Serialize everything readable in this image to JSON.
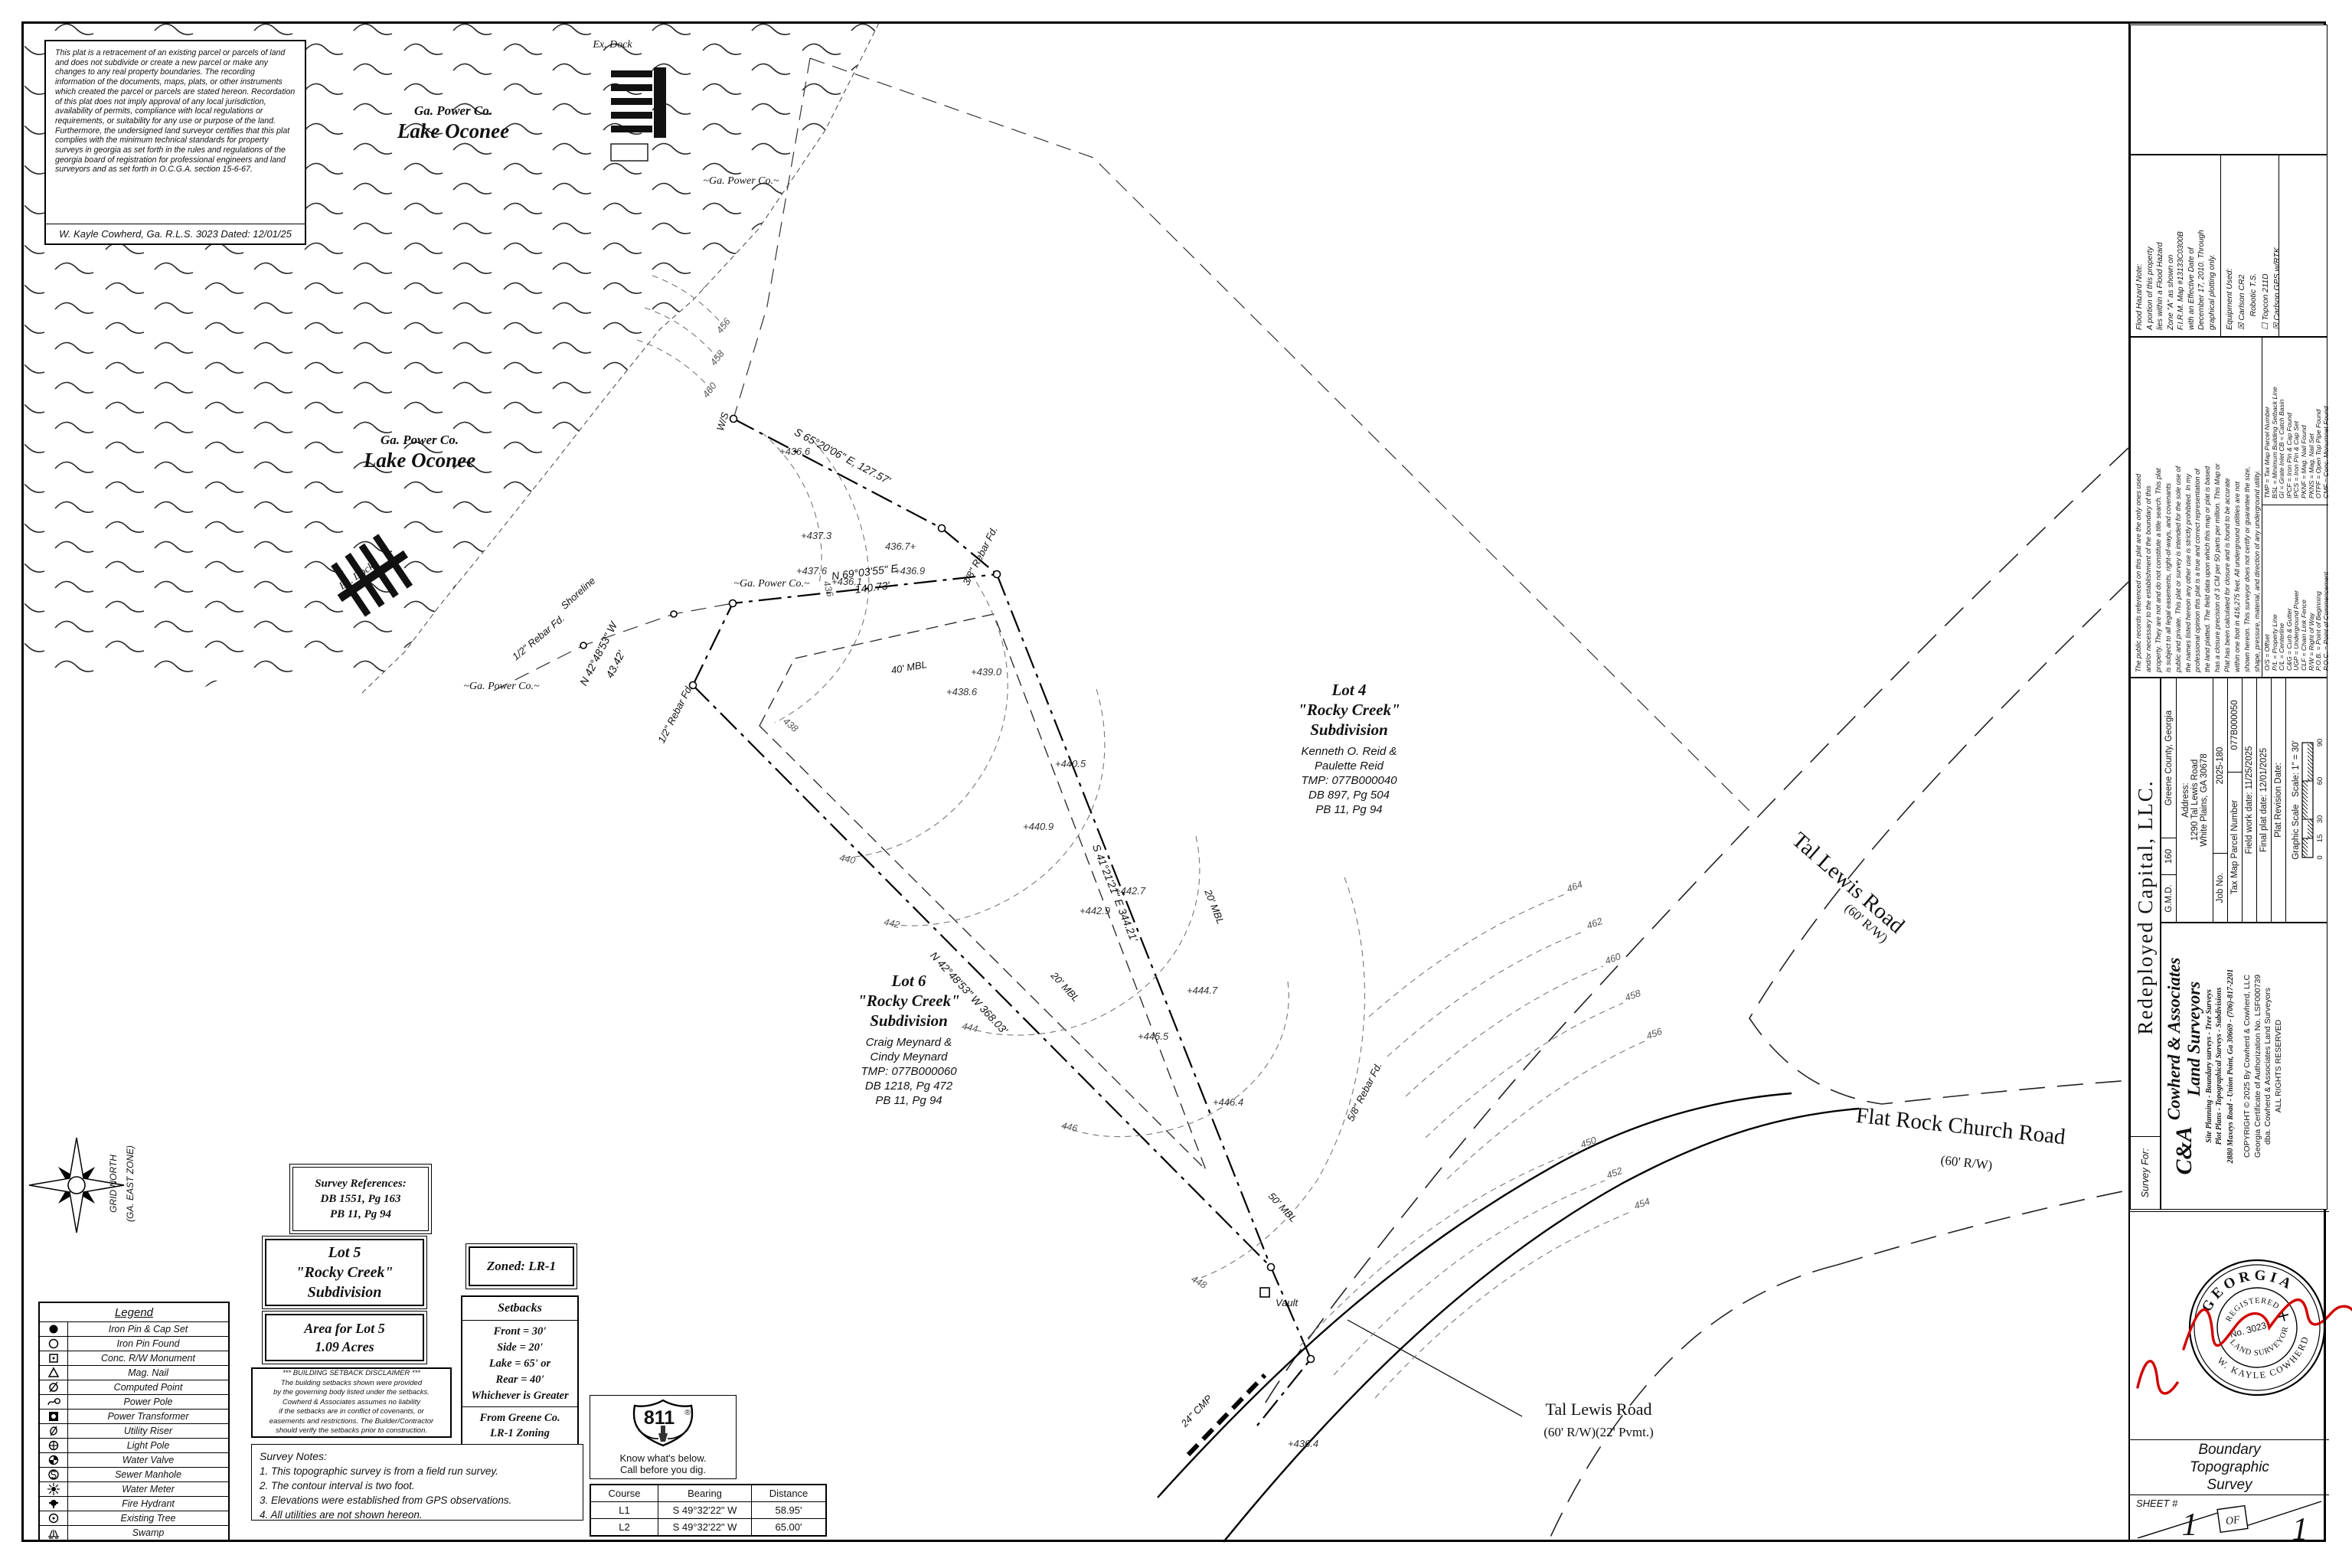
{
  "disclaimer": {
    "text": "This plat is a retracement of an existing parcel or parcels of land and does not subdivide or create a new parcel or make any changes to any real property boundaries. The recording information of the documents, maps, plats, or other instruments which created the parcel or parcels are stated hereon. Recordation of this plat does not imply approval of any local jurisdiction, availability of permits, compliance with local regulations or requirements, or suitability for any use or purpose of the land. Furthermore, the undersigned land surveyor certifies that this plat complies with the minimum technical standards for property surveys in georgia as set forth in the rules and regulations of the georgia board of registration for professional engineers and land surveyors and as set forth in O.C.G.A. section 15-6-67.",
    "signature_line": "W. Kayle Cowherd, Ga. R.L.S. 3023 Dated: 12/01/25"
  },
  "lake": {
    "owner": "Ga. Power Co.",
    "name": "Lake Oconee"
  },
  "map": {
    "labels": {
      "ex_dock_top": "Ex. Dock",
      "ex_dock_left": "Ex. Dock",
      "ga_power_1": "~Ga. Power Co.~",
      "ga_power_2": "~Ga. Power Co.~",
      "ga_power_3": "~Ga. Power Co.~",
      "ws": "W/S",
      "shoreline": "Shoreline",
      "bearing_shore": "S 65°20'06\" E, 127.57'",
      "bearing_top": "N 69°03'55\" E",
      "dist_top": "140.73'",
      "bearing_left": "N 42°48'53\" W",
      "dist_left": "43.42'",
      "bearing_right": "S 41°21'21\" E  344.21'",
      "bearing_bottom": "N 42°48'53\" W  368.03'",
      "rebar_half_1": "1/2\" Rebar Fd.",
      "rebar_half_2": "1/2\" Rebar Fd.",
      "rebar_38": "3/8\" Rebar Fd.",
      "rebar_58": "5/8\" Rebar Fd.",
      "mbl40": "40' MBL",
      "mbl20_right": "20' MBL",
      "mbl20_bottom": "20' MBL",
      "mbl50": "50' MBL",
      "vault": "Vault",
      "cmp": "24\" CMP",
      "tal_lewis_1": "Tal Lewis Road",
      "tal_lewis_1_rw": "(60' R/W)",
      "flat_rock": "Flat Rock Church Road",
      "flat_rock_rw": "(60' R/W)",
      "tal_lewis_2": "Tal Lewis Road",
      "tal_lewis_2_rw": "(60' R/W)(22' Pvmt.)",
      "grid_north": "GRID NORTH",
      "grid_zone": "(GA. EAST ZONE)"
    },
    "lot4": {
      "title": "Lot 4\n\"Rocky Creek\"\nSubdivision",
      "owner": "Kenneth O. Reid &\nPaulette Reid\nTMP: 077B000040\nDB 897, Pg 504\nPB 11, Pg 94"
    },
    "lot6": {
      "title": "Lot 6\n\"Rocky Creek\"\nSubdivision",
      "owner": "Craig Meynard &\nCindy Meynard\nTMP: 077B000060\nDB 1218, Pg 472\nPB 11, Pg 94"
    },
    "spots": [
      "+436.6",
      "+437.3",
      "+437.6",
      "+436.1",
      "436.7+",
      "+436.9",
      "+438.6",
      "+439.0",
      "+440.5",
      "+440.9",
      "+442.7",
      "+442.9",
      "+444.7",
      "+445.5",
      "+446.4",
      "+436.4"
    ],
    "contours": [
      "436",
      "438",
      "440",
      "442",
      "444",
      "446",
      "448",
      "450",
      "452",
      "454",
      "456",
      "458",
      "460",
      "462",
      "464",
      "456",
      "458",
      "460"
    ]
  },
  "boxes": {
    "survey_references": "Survey References:\nDB 1551, Pg 163\nPB 11, Pg 94",
    "lot5": "Lot 5\n\"Rocky Creek\"\nSubdivision",
    "area": "Area for Lot 5\n1.09 Acres",
    "zoned": "Zoned: LR-1",
    "setbacks_title": "Setbacks",
    "setbacks_values": "Front = 30'\nSide = 20'\nLake = 65' or\nRear = 40'\nWhichever is Greater",
    "setbacks_source": "From Greene Co.\nLR-1 Zoning",
    "setback_disclaimer": "*** BUILDING SETBACK DISCLAIMER ***\nThe building setbacks shown were provided\nby the governing body listed under the setbacks.\nCowherd & Associates assumes no liability\nif the setbacks are in conflict of covenants, or\neasements and restrictions. The Builder/Contractor\nshould verify the setbacks prior to construction.",
    "notes_title": "Survey Notes:",
    "notes": "1.  This topographic survey is from a field run survey.\n2.  The contour interval is two foot.\n3.  Elevations were established from GPS observations.\n4.  All utilities are not shown hereon."
  },
  "legend": {
    "title": "Legend",
    "items": [
      "Iron Pin & Cap Set",
      "Iron Pin Found",
      "Conc. R/W Monument",
      "Mag. Nail",
      "Computed Point",
      "Power Pole",
      "Power Transformer",
      "Utility Riser",
      "Light Pole",
      "Water Valve",
      "Sewer Manhole",
      "Water Meter",
      "Fire Hydrant",
      "Existing Tree",
      "Swamp"
    ]
  },
  "call811": {
    "number": "811",
    "reg": "®",
    "line1": "Know what's below.",
    "line2": "Call before you dig."
  },
  "course_table": {
    "headers": [
      "Course",
      "Bearing",
      "Distance"
    ],
    "rows": [
      [
        "L1",
        "S 49°32'22\" W",
        "58.95'"
      ],
      [
        "L2",
        "S 49°32'22\" W",
        "65.00'"
      ]
    ]
  },
  "title_block": {
    "survey_for_label": "Survey For:",
    "client": "Redeployed Capital, LLC.",
    "company": {
      "monogram": "C&A",
      "name1": "Cowherd & Associates",
      "name2": "Land Surveyors",
      "services1": "Site Planning - Boundary surveys - Tree Surveys",
      "services2": "Plot Plans - Topographical Surveys - Subdivisions",
      "address": "2880 Maxeys Road - Union Point, Ga 30669 - (706)-817-2201",
      "copyright": "COPYRIGHT © 2025 By Cowherd & Cowherd, LLC\nGeorgia Certificate of Authorization No. LSF000739\ndba. Cowherd & Associates Land Surveyors\nALL RIGHTS RESERVED"
    },
    "job": {
      "gmd_label": "G.M.D.",
      "gmd": "160",
      "county": "Greene County, Georgia",
      "address": "Address:\n1290 Tal Lewis Road\nWhite Plains, GA 30678",
      "job_no_label": "Job No.",
      "job_no": "2025-180",
      "parcel_label": "Tax Map Parcel Number",
      "parcel": "077B000050",
      "field_date": "Field work date: 11/25/2025",
      "plat_date": "Final plat date: 12/01/2025",
      "revision": "Plat Revision Date:",
      "scale_label": "Graphic Scale",
      "scale": "Scale: 1\" = 30'",
      "ticks": [
        "0",
        "15",
        "30",
        "60",
        "90"
      ]
    },
    "records_note": "The public records referenced on this plat are the only ones used\nand/or necessary to the establishment of the boundary of this\nproperty. They are not and do not constitute a title search. This plat\nis subject to all legal easements, right-of-ways, and covenants\npublic and private. This plat or survey is intended for the sole use of\nthe names listed hereon any other use is strictly prohibited. In my\nprofessional opinion this plat is a true and correct representation of\nthe land platted. The field data upon which this map or plat is based\nhas a closure precision of 3 CM per 50 parts per million. This Map or\nPlat has been calculated for closure and is found to be accurate\nwithin one foot in 416,275 feet. All underground utilities are not\nshown hereon. This surveyor does not certify or guarantee the size,\nshape, pressure, material, and direction of any underground utility.",
    "abbrev_a": "TMP = Tax Map Parcel Number\nBSL = Minimum Building Setback Line\nGI = Grate Inlet  CB = Catch Basin\nIPCF = Iron Pin & Cap Found\nIPCS = Iron Pin & Cap Set\nPKNF = Mag. Nail Found\nPKNS = Mag. Nail Set\nOTPF = Open Top Pipe Found\nCMF = Conc. Monumnet Found",
    "abbrev_b": "O/S = Offset\nP/L = Property Line\nC/L = Centerline\nC&G = Curb & Gutter\nUGP = Underground Power\nCLF = Chain Link Fence\nR/W = Right of Way\nP.O.B. = Point of Beginning\nP.O.C. = Point of Commencement",
    "flood_note": "Flood Hazard Note:\nA portion of this property\nlies within a Flood Hazard\nZone \"A\" as shown on\nF.I.R.M. Map #13133C0300B\nwith an Effective Date of\nDecember 17, 2010. Through\ngraphical plotting only.",
    "equipment": "Equipment Used:\n☒ Carlson CR2\n      Robotic T.S.\n☐ Topcon 211D\n☒ Carlson GPS w/RTK",
    "seal": {
      "top": "GEORGIA",
      "registered": "REGISTERED",
      "number": "No. 3023",
      "bottom_inner": "LAND SURVEYOR",
      "bottom": "W. KAYLE COWHERD"
    },
    "doc_type": "Boundary\nTopographic\nSurvey",
    "sheet": {
      "label": "SHEET #",
      "num": "1",
      "of": "OF",
      "total": "1"
    }
  }
}
